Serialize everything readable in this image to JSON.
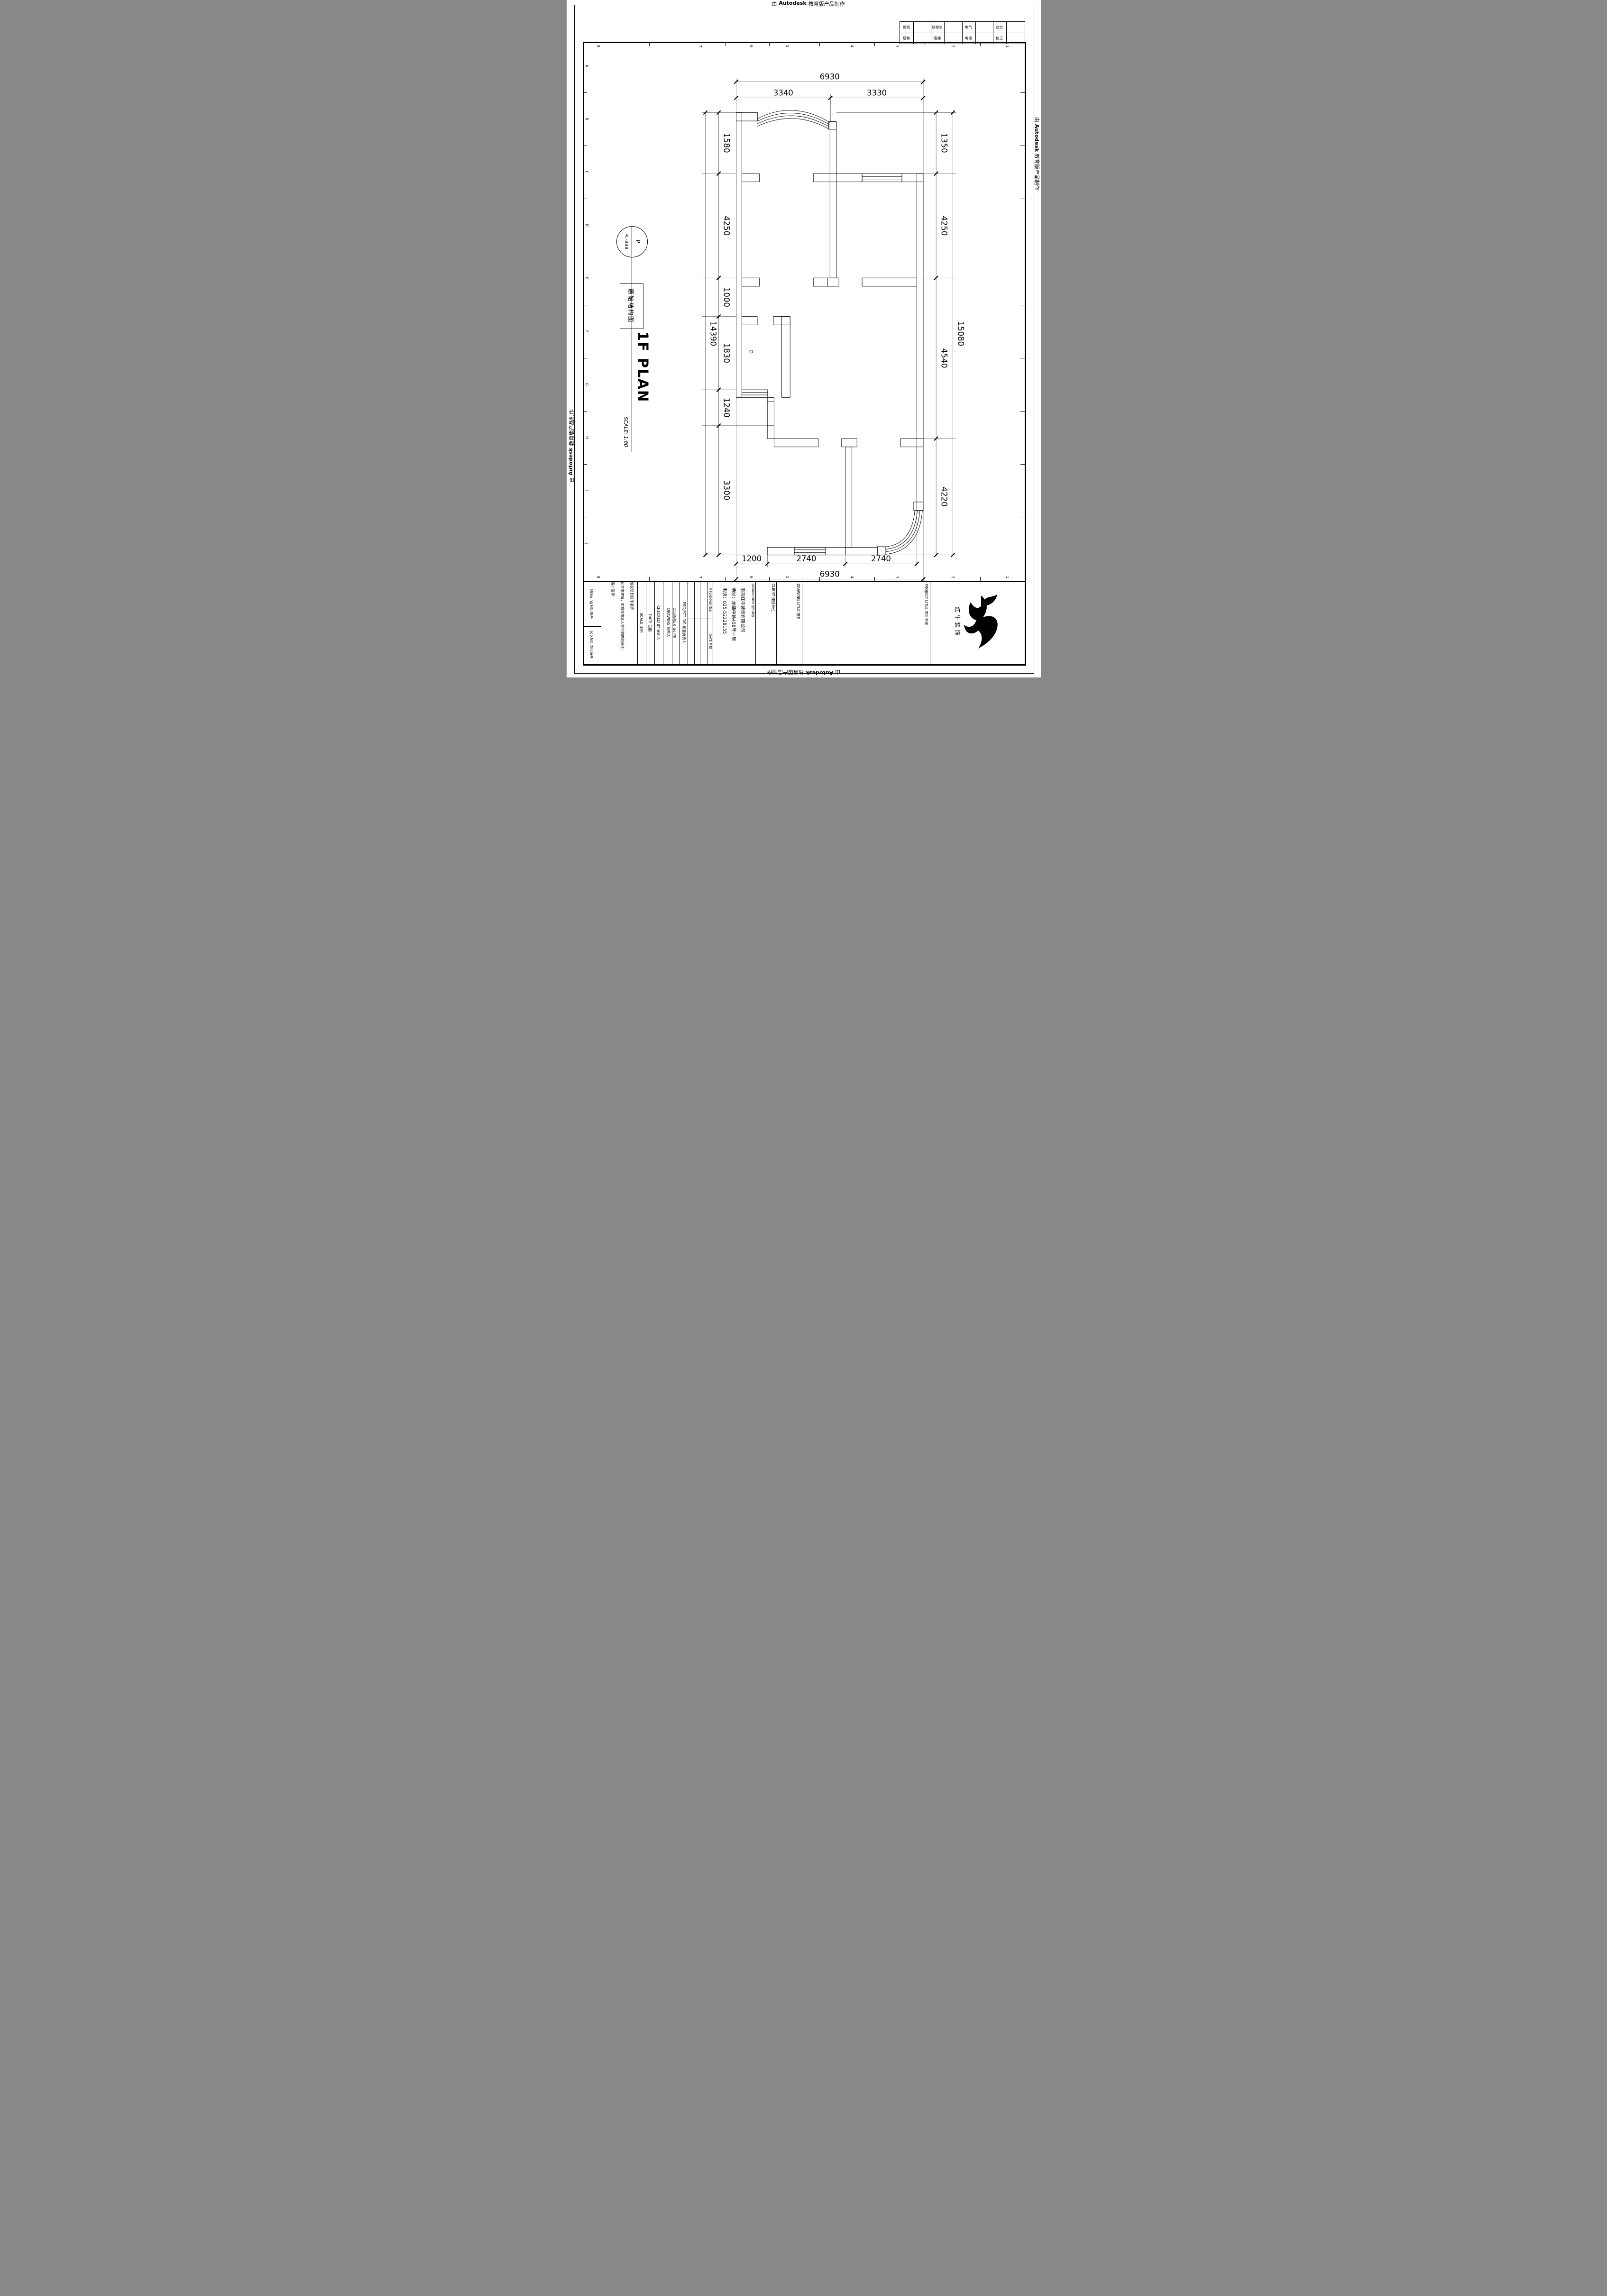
{
  "edge_stamp": {
    "prefix": "由",
    "brand": "Autodesk",
    "suffix": "教育版产品制作"
  },
  "discipline_table": {
    "row1": [
      "建筑",
      "给排水",
      "电气",
      "动力"
    ],
    "row2": [
      "结构",
      "暖通",
      "电讯",
      "校工"
    ]
  },
  "sheet_grid": {
    "cols": [
      "8",
      "7",
      "6",
      "5",
      "4",
      "3",
      "2",
      "1"
    ],
    "rows": [
      "A",
      "B",
      "C",
      "D",
      "E",
      "F",
      "G",
      "H",
      "I",
      "J"
    ]
  },
  "label_panel": {
    "bubble_top": "P",
    "bubble_bottom": "PL-888",
    "drawing_name": "原始结构图",
    "plan_title": "1F PLAN",
    "scale_note": "SCALE: 1:80"
  },
  "dims": {
    "top": {
      "total": "6930",
      "segments": [
        "3340",
        "3330"
      ]
    },
    "left": {
      "total": "14390",
      "segments": [
        "1580",
        "4250",
        "1000",
        "1830",
        "1240",
        "3300"
      ]
    },
    "right": {
      "total": "15080",
      "segments": [
        "1350",
        "4250",
        "4540",
        "4220"
      ]
    },
    "bottom": {
      "total": "6930",
      "segments": [
        "1200",
        "2740",
        "2740"
      ]
    }
  },
  "title_block": {
    "drawing_no": "Drawing NO 图号",
    "job_no": "Job NO 项目编号",
    "disclaimer": [
      "版权所有红牛装饰",
      "此方案理解，同意按由本人签字的图纸施工;",
      "客户签字:"
    ],
    "scale": "SCALE 比例",
    "date": "DATE 日期",
    "checked_by": "CHECKED BY 审定人",
    "drawing": "DRAWING 制图人",
    "designer": "DESIGNER 设计师",
    "project_dir": "PROJECT DIR 项目负责人",
    "revisions": "REVISIONS 版本",
    "rev_date": "DATE 日期",
    "design_firm": "DESIGN FIRM 设计单位",
    "company": {
      "name": "南京红牛装饰有限公司",
      "address": "地址：龙蟠中路458号一层",
      "phone": "电话：025-52228155"
    },
    "client": "CLIENT 建设单位",
    "drawing_title": "DRAWING LITLE 图名",
    "project_title": "PROJECT LITLE 项目名称",
    "logo_text": "红牛装饰"
  }
}
